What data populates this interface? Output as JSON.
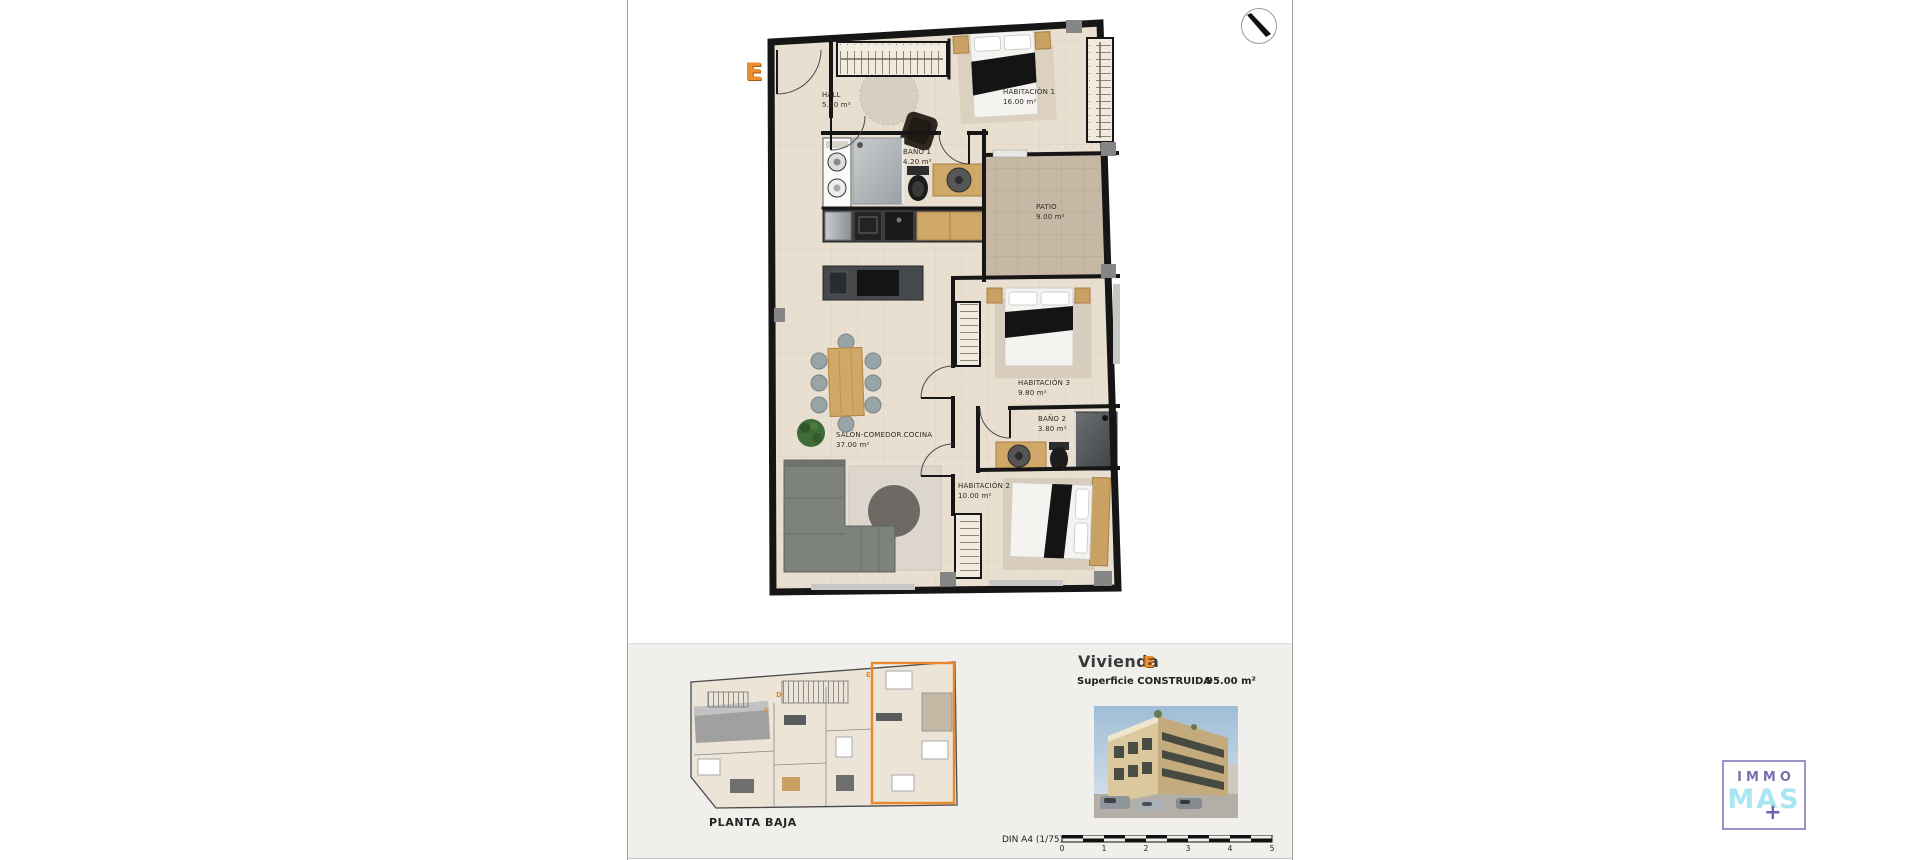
{
  "document": {
    "unit_letter_plan": "E",
    "rooms": [
      {
        "name": "HALL",
        "area": "5.00 m²"
      },
      {
        "name": "HABITACIÓN 1",
        "area": "16.00 m²"
      },
      {
        "name": "BAÑO 1",
        "area": "4.20 m²"
      },
      {
        "name": "PATIO",
        "area": "9.00 m²"
      },
      {
        "name": "SALÓN-COMEDOR.COCINA",
        "area": "37.00 m²"
      },
      {
        "name": "HABITACIÓN 3",
        "area": "9.80 m²"
      },
      {
        "name": "BAÑO 2",
        "area": "3.80 m²"
      },
      {
        "name": "HABITACIÓN 2",
        "area": "10.00 m²"
      }
    ]
  },
  "footer": {
    "floor_label": "PLANTA BAJA",
    "title_prefix": "Vivienda",
    "title_unit": "E",
    "surface_label": "Superficie CONSTRUIDA",
    "surface_value": "95.00 m²",
    "scale_label": "DIN A4 (1/75)",
    "scale_ticks": [
      "0",
      "1",
      "2",
      "3",
      "4",
      "5"
    ],
    "mini_plan_units": [
      {
        "label": "D"
      },
      {
        "label": "F"
      },
      {
        "label": "E"
      }
    ]
  },
  "logo": {
    "top": "IMMO",
    "bottom": "MAS",
    "plus": "+"
  },
  "colors": {
    "accent_orange": "#E8872B",
    "wall_black": "#161616",
    "floor_beige": "#E8DFD0",
    "patio_tan": "#C6B8A4",
    "footer_band": "#F0EFEC",
    "logo_purple": "#7A6FB0",
    "logo_cyan": "#A8E6F1"
  }
}
